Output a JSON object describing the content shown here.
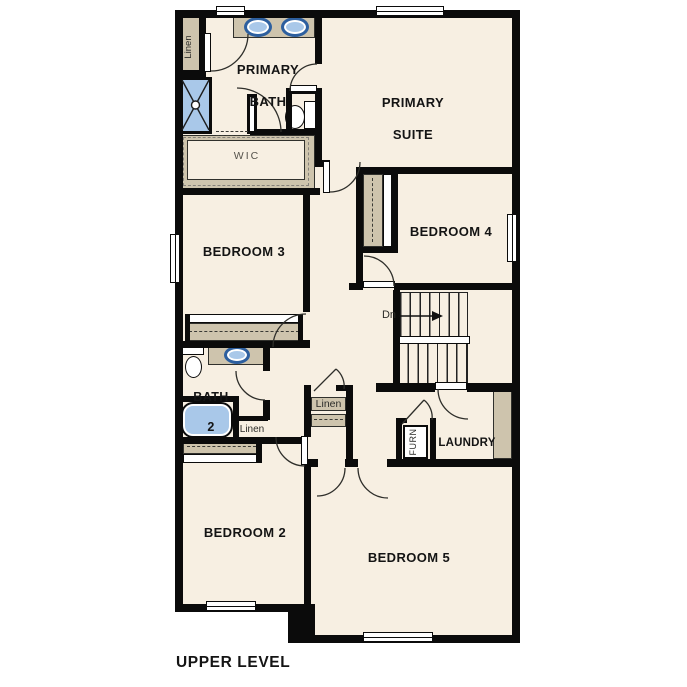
{
  "title": {
    "label": "UPPER LEVEL"
  },
  "rooms": {
    "primary_bath": {
      "line1": "PRIMARY",
      "line2": "BATH"
    },
    "primary_suite": {
      "line1": "PRIMARY",
      "line2": "SUITE"
    },
    "wic": {
      "label": "WIC"
    },
    "bedroom3": {
      "label": "BEDROOM 3"
    },
    "bedroom4": {
      "label": "BEDROOM 4"
    },
    "bath2": {
      "line1": "BATH",
      "line2": "2"
    },
    "bedroom2": {
      "label": "BEDROOM 2"
    },
    "bedroom5": {
      "label": "BEDROOM 5"
    },
    "laundry": {
      "label": "LAUNDRY"
    }
  },
  "closets": {
    "linen_upper_left": {
      "label": "Linen"
    },
    "linen_bath": {
      "label": "Linen"
    },
    "linen_hall": {
      "label": "Linen"
    },
    "furnace": {
      "label": "FURN"
    }
  },
  "stairs": {
    "down_label": "Dn"
  },
  "colors": {
    "floor": "#f7efe2",
    "cabinet": "#cec4ad",
    "fixture_fill": "#a9c8e9",
    "fixture_ring": "#2d5f9f",
    "wall": "#0b0b0b"
  }
}
